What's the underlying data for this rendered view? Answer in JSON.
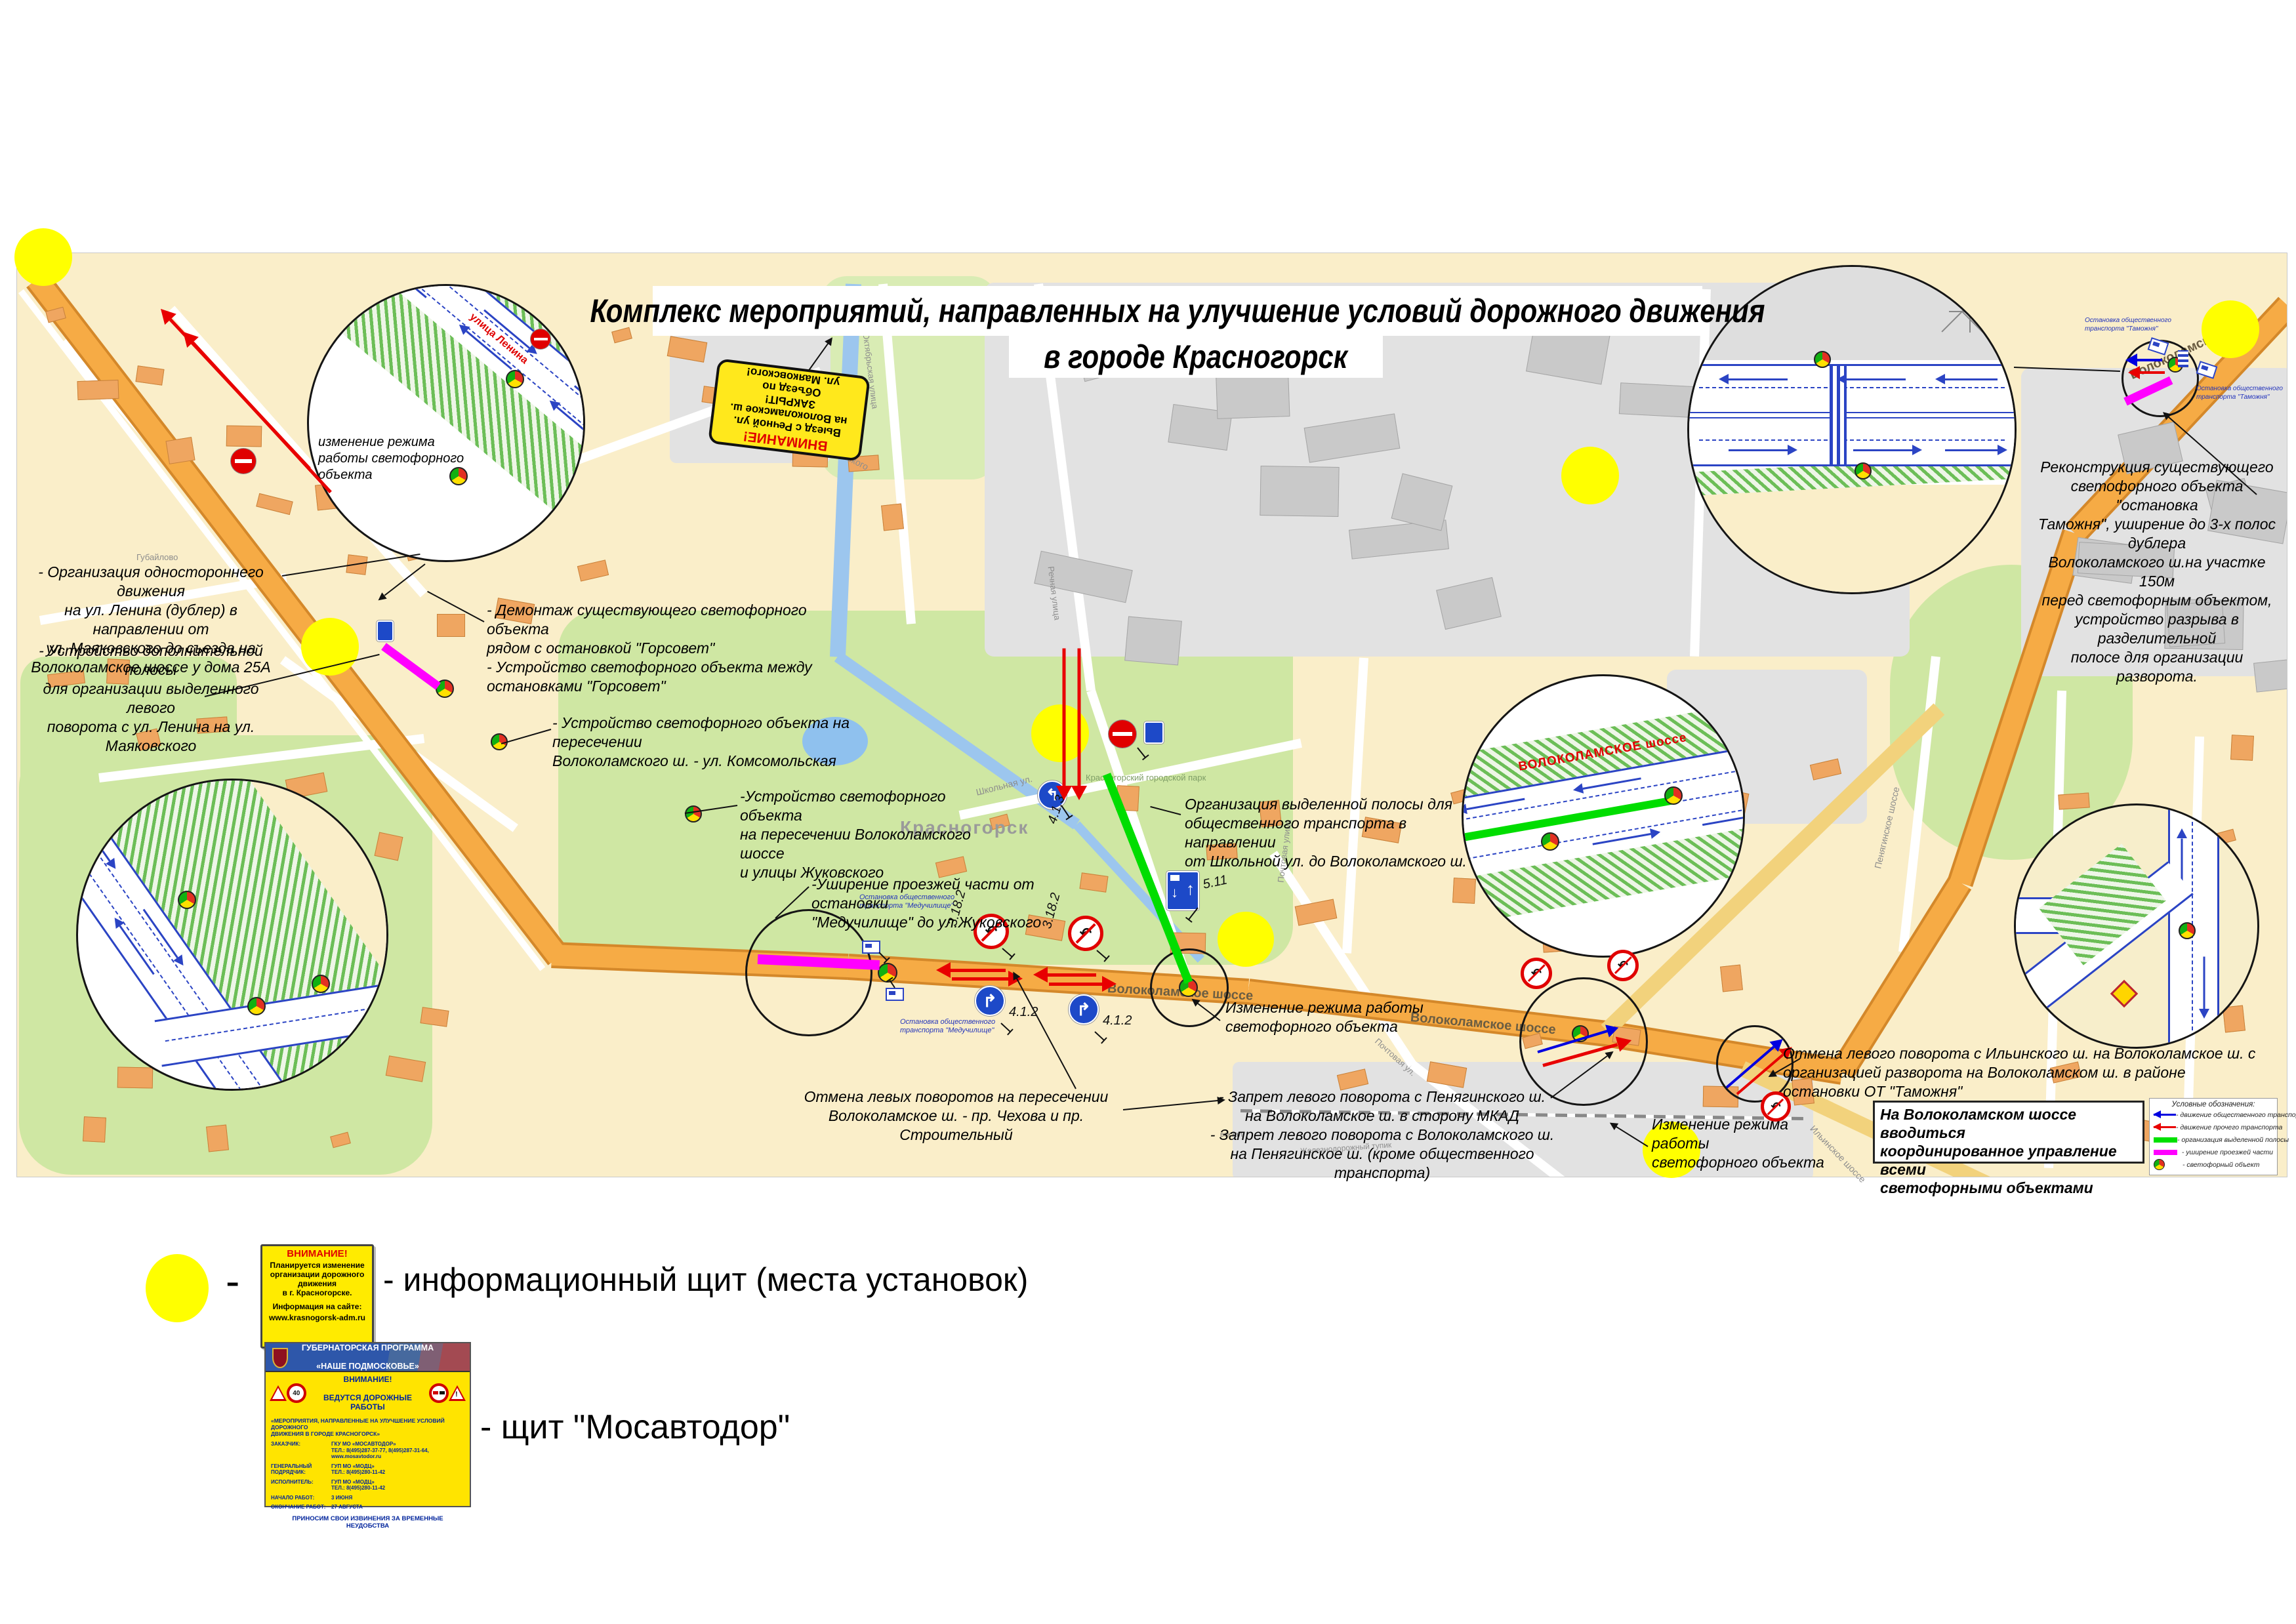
{
  "title": {
    "line1": "Комплекс мероприятий, направленных на улучшение условий дорожного движения",
    "line2": "в городе Красногорск"
  },
  "closed_sign": {
    "title": "ВНИМАНИЕ!",
    "body": "Выезд с Речной ул.\nна Волоколамское ш.\nЗАКРЫТ!\nОбъезд по\nул. Маяковского!"
  },
  "annotations": {
    "one_way": "- Организация одностороннего движения\nна ул. Ленина (дублер) в направлении от\nул. Маяковского до съезда на\nВолоколамское шоссе у дома 25А",
    "extra_lane": "- Устройство дополнительной полосы\nдля организации выделенного левого\nповорота с ул. Ленина на ул. Маяковского",
    "gorsovet": "- Демонтаж существующего светофорного объекта\nрядом с остановкой \"Горсовет\"\n- Устройство светофорного объекта между\nостановками \"Горсовет\"",
    "komsomolskaya": "- Устройство светофорного объекта на пересечении\nВолоколамского ш. - ул. Комсомольская",
    "zhukovskogo": "-Устройство светофорного объекта\nна пересечении Волоколамского шоссе\nи улицы Жуковского",
    "widening": "-Уширение проезжей части от остановки\n\"Медучилище\" до ул.Жуковского",
    "bus_lane": "Организация выделенной полосы для\nобщественного транспорта  в направлении\nот Школьной ул. до Волоколамского ш.",
    "mode_center": "Изменение режима работы\nсветофорного объекта",
    "left_turns": "Отмена левых поворотов на пересечении\nВолоколамское ш. - пр. Чехова и пр. Строительный",
    "penyaginskoe": "- Запрет левого поворота с Пенягинского ш.\nна Волоколамское ш. в сторону МКАД\n- Запрет левого поворота с Волоколамского ш.\nна Пенягинское ш. (кроме общественного транспорта)",
    "ilinskoe": "Отмена левого поворота с Ильинского ш. на Волоколамское ш. с\nорганизацией разворота на Волоколамском ш. в районе\nостановки ОТ \"Таможня\"",
    "mode_right": "Изменение режима работы\nсветофорного объекта",
    "reconstruction": "Реконструкция существующего\nсветофорного объекта \"остановка\nТаможня\",  уширение до 3-х полос дублера\nВолоколамского ш.на участке 150м\nперед светофорным объектом,\nустройство разрыва в разделительной\nполосе для организации разворота.",
    "mode_circle": "изменение режима\nработы светофорного\nобъекта"
  },
  "coordination": "На Волоколамском шоссе вводиться\nкоординированное управление всеми\nсветофорными объектами",
  "map_legend": {
    "title": "Условные обозначения:",
    "items": [
      "- движение общественного транспорта",
      "- движение прочего транспорта",
      "- организация выделенной полосы",
      "- уширение проезжей части",
      "- светофорный объект"
    ]
  },
  "streets": {
    "lenina": "улица Ленина",
    "volokolamskoe": "Волоколамское шоссе",
    "volokolamskoe_short": "Волоколамское ш.",
    "volokolamskoe_caps": "ВОЛОКОЛАМСКОЕ шоссе",
    "mayakovskogo": "улица Маяковского",
    "oktyabrskaya": "Октябрьская улица",
    "rechnaya": "Речная улица",
    "shkolnaya": "Школьная ул.",
    "pochtovaya": "Почтовая ул.",
    "pochtovaya_full": "Почтовая улица",
    "penyaginskoe": "Пенягинское шоссе",
    "ilinskoe": "Ильинское шоссе",
    "zh_tupik": "Железнодорожный тупик",
    "vokzal": "вокзал",
    "gubaylovo": "Губайлово",
    "city": "Красногорск",
    "park": "Красногорский городской парк"
  },
  "signs": {
    "no_left": "3.18.2",
    "turn_right": "4.1.2",
    "bus_lane": "5.11",
    "turn_left": "4.1.3"
  },
  "bus_stops": {
    "meduchilishche": "Остановка общественного\nтранспорта \"Медучилище\"",
    "tamozhnya": "Остановка общественного\nтранспорта \"Таможня\""
  },
  "legend": {
    "dash": "-",
    "info_sign": {
      "title": "ВНИМАНИЕ!",
      "body": "Планируется изменение\nорганизации дорожного движения\nв г. Красногорске.",
      "site_label": "Информация на сайте:",
      "site": "www.krasnogorsk-adm.ru"
    },
    "info_caption": "- информационный щит (места установок)",
    "mos_sign": {
      "program1": "ГУБЕРНАТОРСКАЯ ПРОГРАММА",
      "program2": "«НАШЕ ПОДМОСКОВЬЕ»",
      "warn1": "ВНИМАНИЕ!",
      "warn2": "ВЕДУТСЯ ДОРОЖНЫЕ РАБОТЫ",
      "speed": "40",
      "subject": "«МЕРОПРИЯТИЯ, НАПРАВЛЕННЫЕ НА УЛУЧШЕНИЕ УСЛОВИЙ ДОРОЖНОГО\nДВИЖЕНИЯ В ГОРОДЕ КРАСНОГОРСК»",
      "rows": [
        {
          "label": "ЗАКАЗЧИК:",
          "value": "ГКУ МО «МОСАВТОДОР»\nТЕЛ.: 8(495)287-37-77, 8(495)287-31-64, www.mosavtodor.ru"
        },
        {
          "label": "ГЕНЕРАЛЬНЫЙ\nПОДРЯДЧИК:",
          "value": "ГУП МО «МОДЦ»\nТЕЛ.: 8(495)280-11-42"
        },
        {
          "label": "ИСПОЛНИТЕЛЬ:",
          "value": "ГУП МО «МОДЦ»\nТЕЛ.: 8(495)280-11-42"
        },
        {
          "label": "НАЧАЛО РАБОТ:",
          "value": "3 ИЮНЯ"
        },
        {
          "label": "ОКОНЧАНИЕ РАБОТ:",
          "value": "27 АВГУСТА"
        }
      ],
      "footer": "ПРИНОСИМ СВОИ ИЗВИНЕНИЯ ЗА ВРЕМЕННЫЕ НЕУДОБСТВА"
    },
    "mos_caption": "- щит \"Мосавтодор\""
  },
  "colors": {
    "public_transport": "#0000e0",
    "other_transport": "#e80000",
    "dedicated_lane": "#00e000",
    "widening": "#ff00ff",
    "info_point": "#ffff00",
    "road": "#f4a43c"
  }
}
